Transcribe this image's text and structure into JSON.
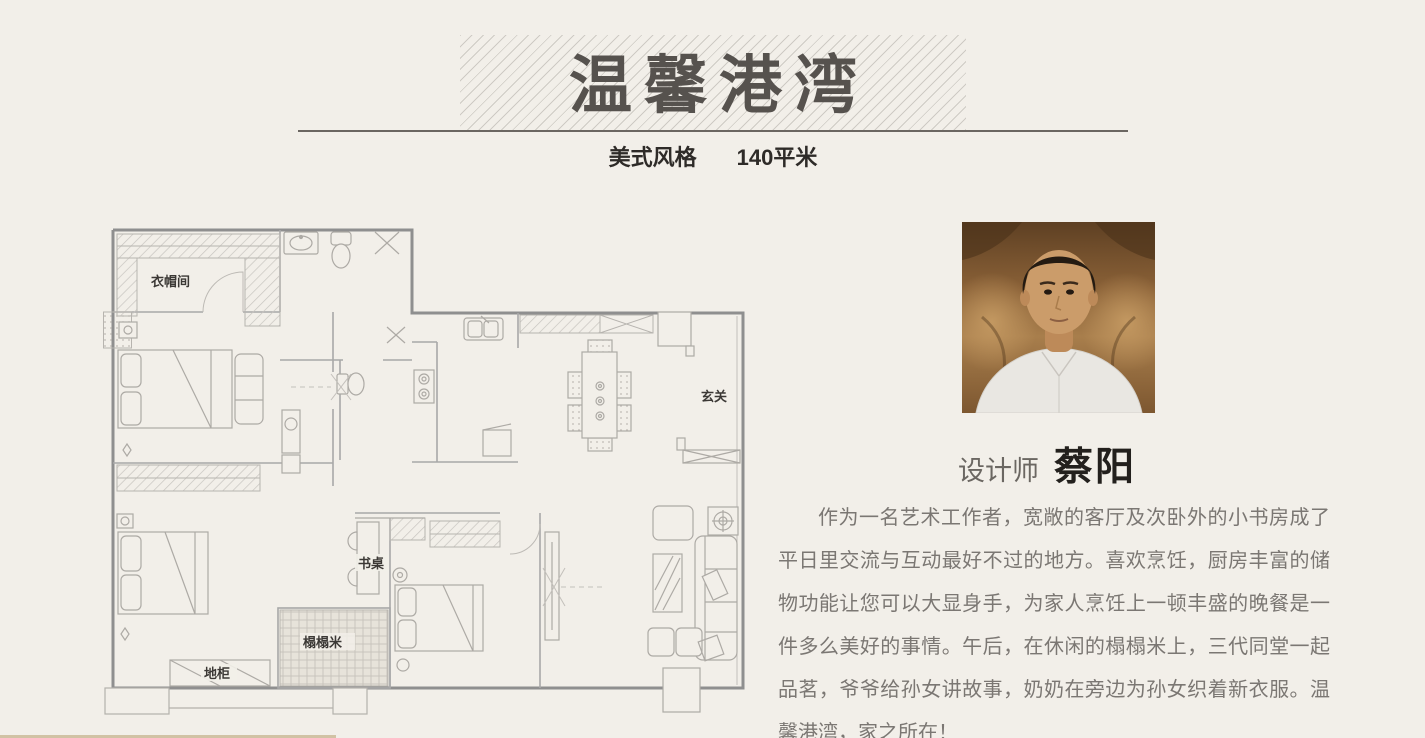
{
  "page": {
    "background_color": "#f2efe9",
    "bottom_bar_color": "#d1c2a4"
  },
  "colors": {
    "title_text": "#56524e",
    "divider": "#6b6661",
    "subtitle_text": "#2e2b28",
    "designer_name_text": "#23201d",
    "body_text": "#7b7773",
    "plan_lines": "#9a9a9a"
  },
  "header": {
    "title": "温馨港湾",
    "style_label": "美式风格",
    "area_label": "140平米"
  },
  "floorplan": {
    "labels": {
      "cloakroom": "衣帽间",
      "entrance": "玄关",
      "desk": "书桌",
      "tatami": "榻榻米",
      "floor_cabinet": "地柜"
    }
  },
  "designer": {
    "role_label": "设计师",
    "name": "蔡阳",
    "bio": "作为一名艺术工作者，宽敞的客厅及次卧外的小书房成了平日里交流与互动最好不过的地方。喜欢烹饪，厨房丰富的储物功能让您可以大显身手，为家人烹饪上一顿丰盛的晚餐是一件多么美好的事情。午后，在休闲的榻榻米上，三代同堂一起品茗，爷爷给孙女讲故事，奶奶在旁边为孙女织着新衣服。温馨港湾，家之所在！"
  }
}
